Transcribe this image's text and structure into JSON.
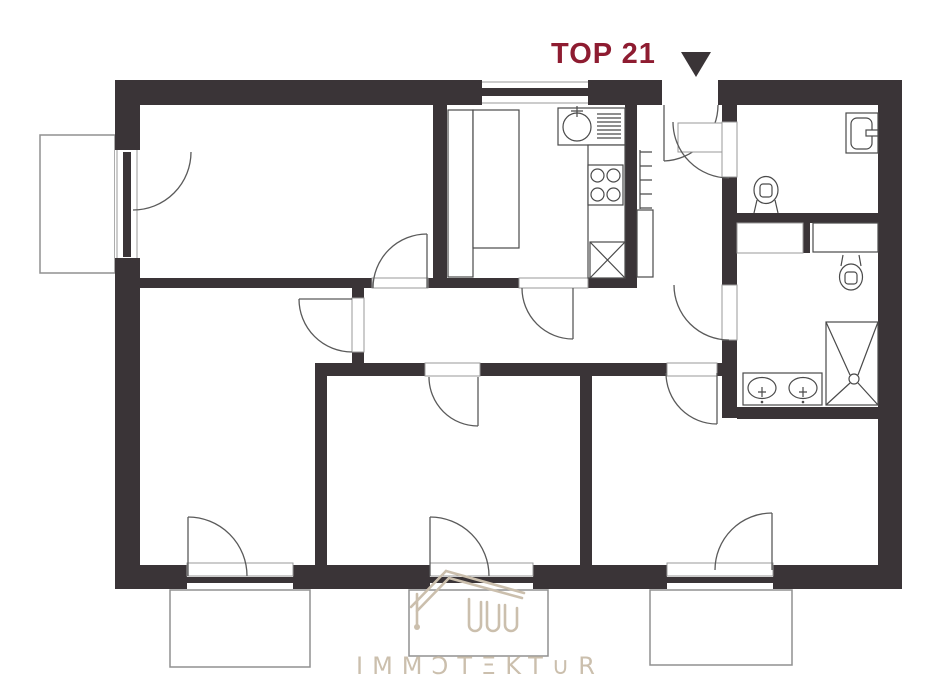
{
  "header": {
    "unit_label": "TOP 21",
    "unit_label_color": "#8e1c31",
    "entrance_marker_icon": "down-triangle-icon"
  },
  "watermark": {
    "brand": "IMMOTEKTUR",
    "display_text": "IMMƆTΞKT∪R",
    "logo_icon": "house-roof-logo-icon",
    "color": "#cbbfad"
  },
  "palette": {
    "wall": "#3a3437",
    "accent_red": "#8e1c31",
    "fixture_line": "#4a4a4a",
    "door_arc_line": "#5a5a5a",
    "balcony_line": "#909090",
    "background": "#ffffff"
  },
  "plan": {
    "type": "apartment-floor-plan",
    "balconies_count": 4,
    "swing_doors_count": 9,
    "french_doors_count": 4,
    "windows_count": 1,
    "fixture_icons": [
      "kitchen-sink-icon",
      "drainboard-icon",
      "stove-4-burner-icon",
      "refrigerator-x-icon",
      "kitchen-cabinet-icon",
      "radiator-icon",
      "washbasin-icon",
      "wc-toilet-icon",
      "bath-toilet-icon",
      "shower-icon",
      "double-vanity-icon",
      "storage-shelf-icon"
    ]
  }
}
